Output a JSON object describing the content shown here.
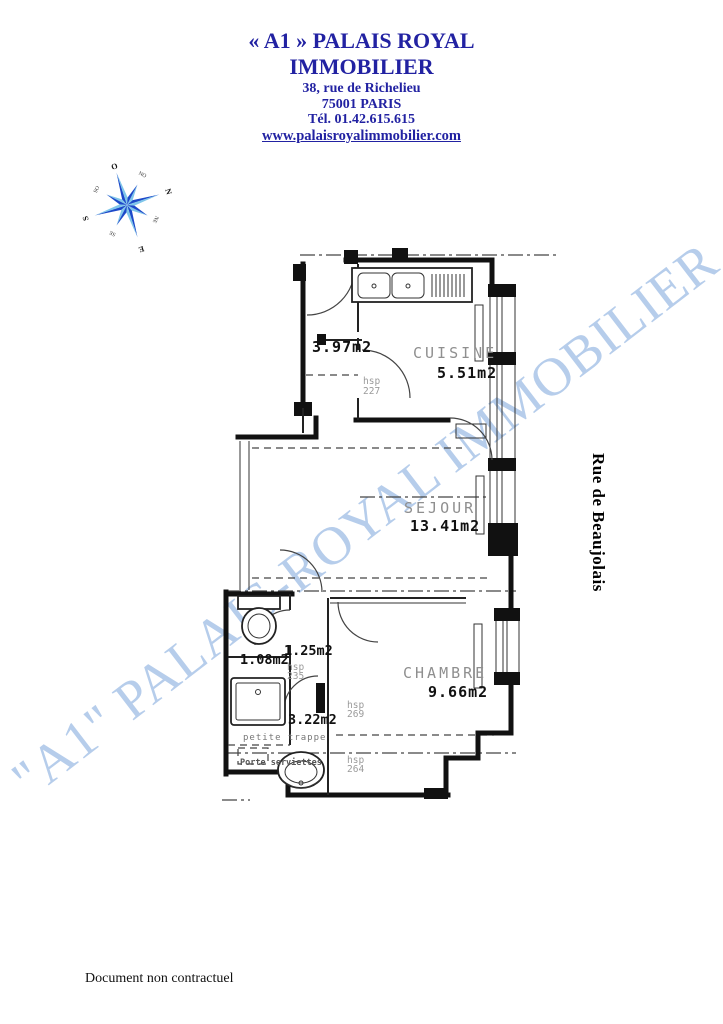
{
  "header": {
    "line1": "« A1 » PALAIS ROYAL",
    "line2": "IMMOBILIER",
    "address1": "38, rue de Richelieu",
    "address2": "75001  PARIS",
    "phone": "Tél. 01.42.615.615",
    "website": "www.palaisroyalimmobilier.com"
  },
  "compass": {
    "top": "O",
    "right": "N",
    "bottom": "E",
    "left": "S",
    "top_right": "NO",
    "bottom_right": "NE",
    "bottom_left": "SE",
    "top_left": "SO"
  },
  "watermark_text": "\"A1\" PALAIS-ROYAL IMMOBILIER",
  "street_name": "Rue de Beaujolais",
  "footer_note": "Document non contractuel",
  "plan": {
    "entry_area": "3.97m2",
    "cuisine_name": "CUISINE",
    "cuisine_area": "5.51m2",
    "sejour_name": "SEJOUR",
    "sejour_area": "13.41m2",
    "chambre_name": "CHAMBRE",
    "chambre_area": "9.66m2",
    "hall_area": "1.25m2",
    "wc_area": "1.08m2",
    "shower_area": "3.22m2",
    "hsp_label": "hsp",
    "hsp_227": "227",
    "hsp_235": "235",
    "hsp_269": "269",
    "hsp_264": "264",
    "note_trappe": "petite trappe",
    "note_serviettes": "Porte serviettes"
  },
  "colors": {
    "brand_navy": "#2222a2",
    "watermark_blue": "#b6cdeb",
    "plan_grey": "#8f8f8f",
    "compass_dark": "#1c49c9",
    "compass_light": "#7fc6ea"
  }
}
